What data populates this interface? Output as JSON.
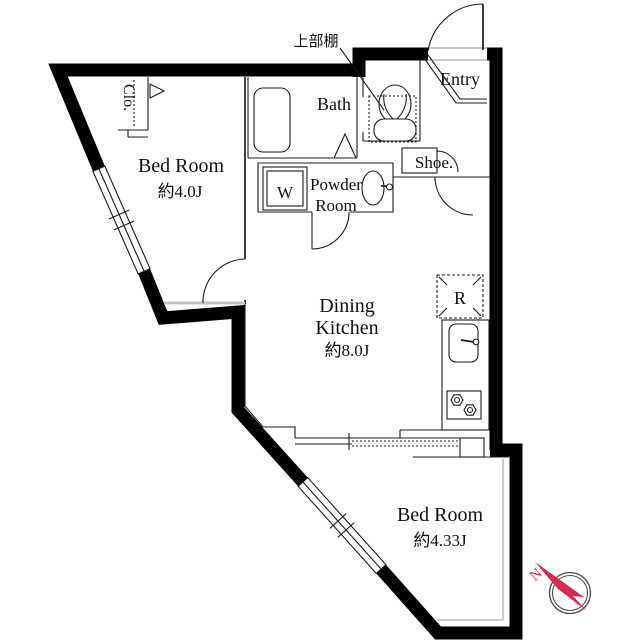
{
  "plan": {
    "bedroom1": {
      "name": "Bed Room",
      "area": "約4.0J"
    },
    "bedroom2": {
      "name": "Bed Room",
      "area": "約4.33J"
    },
    "dining_kitchen": {
      "line1": "Dining",
      "line2": "Kitchen",
      "area": "約8.0J"
    },
    "bath": {
      "name": "Bath"
    },
    "powder_room": {
      "line1": "Powder",
      "line2": "Room"
    },
    "entry": {
      "name": "Entry"
    },
    "shoe": {
      "name": "Shoe."
    },
    "closet": {
      "name": "Clo."
    },
    "washer": {
      "name": "W"
    },
    "fridge": {
      "name": "R"
    },
    "upper_shelf": {
      "name": "上部棚"
    },
    "compass": {
      "north": "N"
    }
  },
  "colors": {
    "wall": "#000000",
    "compass_red": "#d62a52"
  }
}
